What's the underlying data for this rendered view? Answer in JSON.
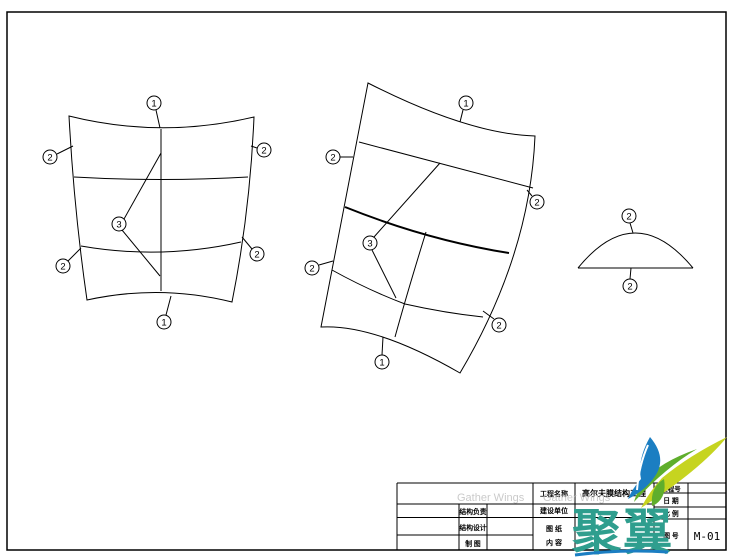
{
  "page": {
    "background": "#ffffff",
    "line_color": "#000000"
  },
  "callouts": {
    "panel_a": [
      "1",
      "2",
      "2",
      "3",
      "2",
      "2",
      "1"
    ],
    "panel_b": [
      "1",
      "2",
      "2",
      "3",
      "2",
      "2",
      "1"
    ],
    "panel_c": [
      "2",
      "2"
    ]
  },
  "title_block": {
    "project_label": "工程名称",
    "project_value": "高尔夫膜结构工程",
    "client_label": "建设单位",
    "content_label_line1": "图  纸",
    "content_label_line2": "内  容",
    "structure_lead_label": "结构负责",
    "structure_design_label": "结构设计",
    "drafting_label": "制  图",
    "project_no_label": "工程号",
    "date_label": "日  期",
    "scale_label": "比  例",
    "drawing_no_label": "图  号",
    "drawing_no_value": "M-01"
  },
  "logo": {
    "company_text": "聚翼",
    "watermark_text": "Gather Wings",
    "colors": {
      "teal": "#2f9e8e",
      "blue": "#1b7ec2",
      "green": "#5fae2c",
      "yellow_green": "#c6d420",
      "watermark_gray": "#bdbdbd"
    }
  }
}
